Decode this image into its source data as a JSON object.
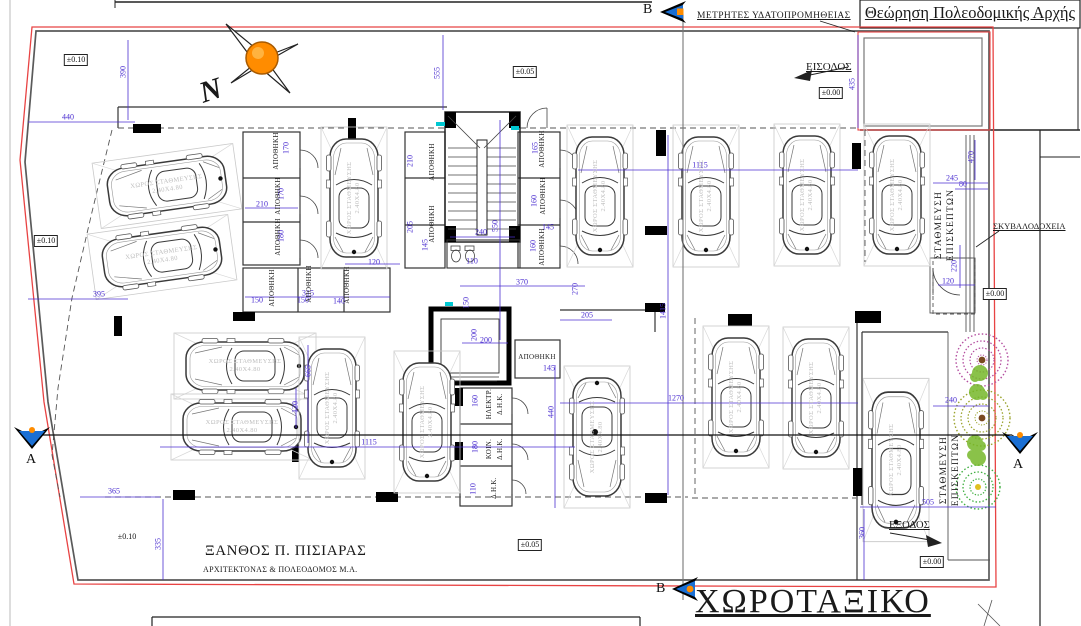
{
  "colors": {
    "dimension_blue": "#4b2fd0",
    "boundary_red": "#e84343",
    "wall_gray": "#5a5a5a",
    "ink_black": "#111111",
    "marker_blue": "#1a6fd4",
    "accent_orange": "#ff8c00",
    "tree_magenta": "#b44fa0",
    "tree_olive": "#9aa32c",
    "tree_green": "#3fae3f",
    "bush_green": "#76b82a",
    "cyan_tick": "#00c8d2"
  },
  "sheet": {
    "approval_title": "Θεώρηση Πολεοδομικής Αρχής",
    "drawing_title": "ΧΩΡΟΤΑΞΙΚΟ"
  },
  "signature": {
    "name": "ΞΑΝΘΟΣ Π. ΠΙΣΙΑΡΑΣ",
    "role": "ΑΡΧΙΤΕΚΤΟΝΑΣ & ΠΟΛΕΟΔΟΜΟΣ Μ.Α."
  },
  "annotations": {
    "water_meters": "ΜΕΤΡΗΤΕΣ ΥΔΑΤΟΠΡΟΜΗΘΕΙΑΣ",
    "entrance": "ΕΙΣΟΔΟΣ",
    "exit": "ΕΞΟΔΟΣ",
    "bins": "ΣΚΥΒΑΛΟΔΟΧΕΙΑ",
    "visitor_parking": [
      "ΣΤΑΘΜΕΥΣΗ",
      "ΕΠΙΣΚΕΠΤΩΝ"
    ],
    "north": "N"
  },
  "section_markers": {
    "a": "A",
    "b": "B"
  },
  "parking": {
    "space_label": "ΧΩΡΟΣ ΣΤΑΘΜΕΥΣΗΣ",
    "space_size": "2.40X4.80"
  },
  "elevations": [
    {
      "t": "±0.10",
      "x": 76,
      "y": 60,
      "boxed": true
    },
    {
      "t": "±0.05",
      "x": 525,
      "y": 72,
      "boxed": true
    },
    {
      "t": "±0.10",
      "x": 46,
      "y": 241,
      "boxed": true
    },
    {
      "t": "±0.00",
      "x": 831,
      "y": 93,
      "boxed": true
    },
    {
      "t": "±0.00",
      "x": 995,
      "y": 294,
      "boxed": true
    },
    {
      "t": "±0.05",
      "x": 530,
      "y": 545,
      "boxed": true
    },
    {
      "t": "±0.00",
      "x": 932,
      "y": 562,
      "boxed": true
    },
    {
      "t": "±0.10",
      "x": 127,
      "y": 537,
      "boxed": false
    }
  ],
  "dimensions": [
    {
      "t": "390",
      "x": 123,
      "y": 72,
      "v": true
    },
    {
      "t": "440",
      "x": 68,
      "y": 117,
      "v": false
    },
    {
      "t": "555",
      "x": 437,
      "y": 73,
      "v": true
    },
    {
      "t": "435",
      "x": 852,
      "y": 84,
      "v": true
    },
    {
      "t": "1115",
      "x": 700,
      "y": 165,
      "v": false
    },
    {
      "t": "245",
      "x": 952,
      "y": 178,
      "v": false
    },
    {
      "t": "470",
      "x": 971,
      "y": 157,
      "v": true
    },
    {
      "t": "80",
      "x": 963,
      "y": 184,
      "v": false
    },
    {
      "t": "220",
      "x": 954,
      "y": 266,
      "v": true
    },
    {
      "t": "120",
      "x": 948,
      "y": 281,
      "v": false
    },
    {
      "t": "395",
      "x": 99,
      "y": 294,
      "v": false
    },
    {
      "t": "210",
      "x": 262,
      "y": 204,
      "v": false
    },
    {
      "t": "170",
      "x": 286,
      "y": 148,
      "v": true
    },
    {
      "t": "170",
      "x": 281,
      "y": 194,
      "v": true
    },
    {
      "t": "180",
      "x": 281,
      "y": 236,
      "v": true
    },
    {
      "t": "150",
      "x": 257,
      "y": 300,
      "v": false
    },
    {
      "t": "150",
      "x": 303,
      "y": 300,
      "v": false
    },
    {
      "t": "140",
      "x": 339,
      "y": 301,
      "v": false
    },
    {
      "t": "120",
      "x": 374,
      "y": 262,
      "v": false
    },
    {
      "t": "315",
      "x": 308,
      "y": 293,
      "v": false
    },
    {
      "t": "210",
      "x": 410,
      "y": 161,
      "v": true
    },
    {
      "t": "205",
      "x": 410,
      "y": 227,
      "v": true
    },
    {
      "t": "145",
      "x": 425,
      "y": 245,
      "v": true
    },
    {
      "t": "240",
      "x": 481,
      "y": 232,
      "v": false
    },
    {
      "t": "550",
      "x": 495,
      "y": 226,
      "v": true
    },
    {
      "t": "110",
      "x": 472,
      "y": 261,
      "v": false
    },
    {
      "t": "150",
      "x": 466,
      "y": 303,
      "v": true
    },
    {
      "t": "165",
      "x": 535,
      "y": 148,
      "v": true
    },
    {
      "t": "160",
      "x": 534,
      "y": 201,
      "v": true
    },
    {
      "t": "145",
      "x": 548,
      "y": 227,
      "v": false
    },
    {
      "t": "160",
      "x": 533,
      "y": 246,
      "v": true
    },
    {
      "t": "370",
      "x": 522,
      "y": 282,
      "v": false
    },
    {
      "t": "270",
      "x": 575,
      "y": 289,
      "v": true
    },
    {
      "t": "205",
      "x": 587,
      "y": 315,
      "v": false
    },
    {
      "t": "200",
      "x": 486,
      "y": 340,
      "v": false
    },
    {
      "t": "200",
      "x": 474,
      "y": 335,
      "v": true
    },
    {
      "t": "145",
      "x": 549,
      "y": 368,
      "v": false
    },
    {
      "t": "160",
      "x": 475,
      "y": 401,
      "v": true
    },
    {
      "t": "180",
      "x": 475,
      "y": 447,
      "v": true
    },
    {
      "t": "110",
      "x": 473,
      "y": 489,
      "v": true
    },
    {
      "t": "440",
      "x": 551,
      "y": 412,
      "v": true
    },
    {
      "t": "665",
      "x": 308,
      "y": 371,
      "v": true
    },
    {
      "t": "1115",
      "x": 369,
      "y": 442,
      "v": false
    },
    {
      "t": "120",
      "x": 295,
      "y": 407,
      "v": true
    },
    {
      "t": "1270",
      "x": 676,
      "y": 398,
      "v": false
    },
    {
      "t": "1415",
      "x": 663,
      "y": 311,
      "v": true
    },
    {
      "t": "240",
      "x": 951,
      "y": 400,
      "v": false
    },
    {
      "t": "505",
      "x": 928,
      "y": 502,
      "v": false
    },
    {
      "t": "360",
      "x": 862,
      "y": 533,
      "v": true
    },
    {
      "t": "365",
      "x": 114,
      "y": 491,
      "v": false
    },
    {
      "t": "335",
      "x": 158,
      "y": 544,
      "v": true
    }
  ],
  "room_labels": [
    {
      "t": "ΑΠΟΘΗΚΗ",
      "x": 276,
      "y": 151,
      "v": true
    },
    {
      "t": "ΑΠΟΘΗΚΗ",
      "x": 278,
      "y": 196,
      "v": true
    },
    {
      "t": "ΑΠΟΘΗΚΗ",
      "x": 278,
      "y": 237,
      "v": true
    },
    {
      "t": "ΑΠΟΘΗΚΗ",
      "x": 272,
      "y": 288,
      "v": true
    },
    {
      "t": "ΑΠΟΘΗΚΗ",
      "x": 309,
      "y": 284,
      "v": true
    },
    {
      "t": "ΑΠΟΘΗΚΗ",
      "x": 347,
      "y": 285,
      "v": true
    },
    {
      "t": "ΑΠΟΘΗΚΗ",
      "x": 432,
      "y": 162,
      "v": true
    },
    {
      "t": "ΑΠΟΘΗΚΗ",
      "x": 432,
      "y": 224,
      "v": true
    },
    {
      "t": "ΑΠΟΘΗΚΗ",
      "x": 542,
      "y": 149,
      "v": true
    },
    {
      "t": "ΑΠΟΘΗΚΗ",
      "x": 543,
      "y": 196,
      "v": true
    },
    {
      "t": "ΑΠΟΘΗΚΗ",
      "x": 542,
      "y": 247,
      "v": true
    },
    {
      "t": "ΑΠΟΘΗΚΗ",
      "x": 537,
      "y": 357,
      "v": false
    },
    {
      "t": "ΗΛΕΚΤΡ.",
      "x": 489,
      "y": 404,
      "v": true
    },
    {
      "t": "Δ.Η.Κ.",
      "x": 500,
      "y": 404,
      "v": true
    },
    {
      "t": "ΚΟΙΝ.",
      "x": 489,
      "y": 449,
      "v": true
    },
    {
      "t": "Δ.Η.Κ.",
      "x": 500,
      "y": 449,
      "v": true
    },
    {
      "t": "Δ.Η.Κ.",
      "x": 494,
      "y": 488,
      "v": true
    }
  ]
}
